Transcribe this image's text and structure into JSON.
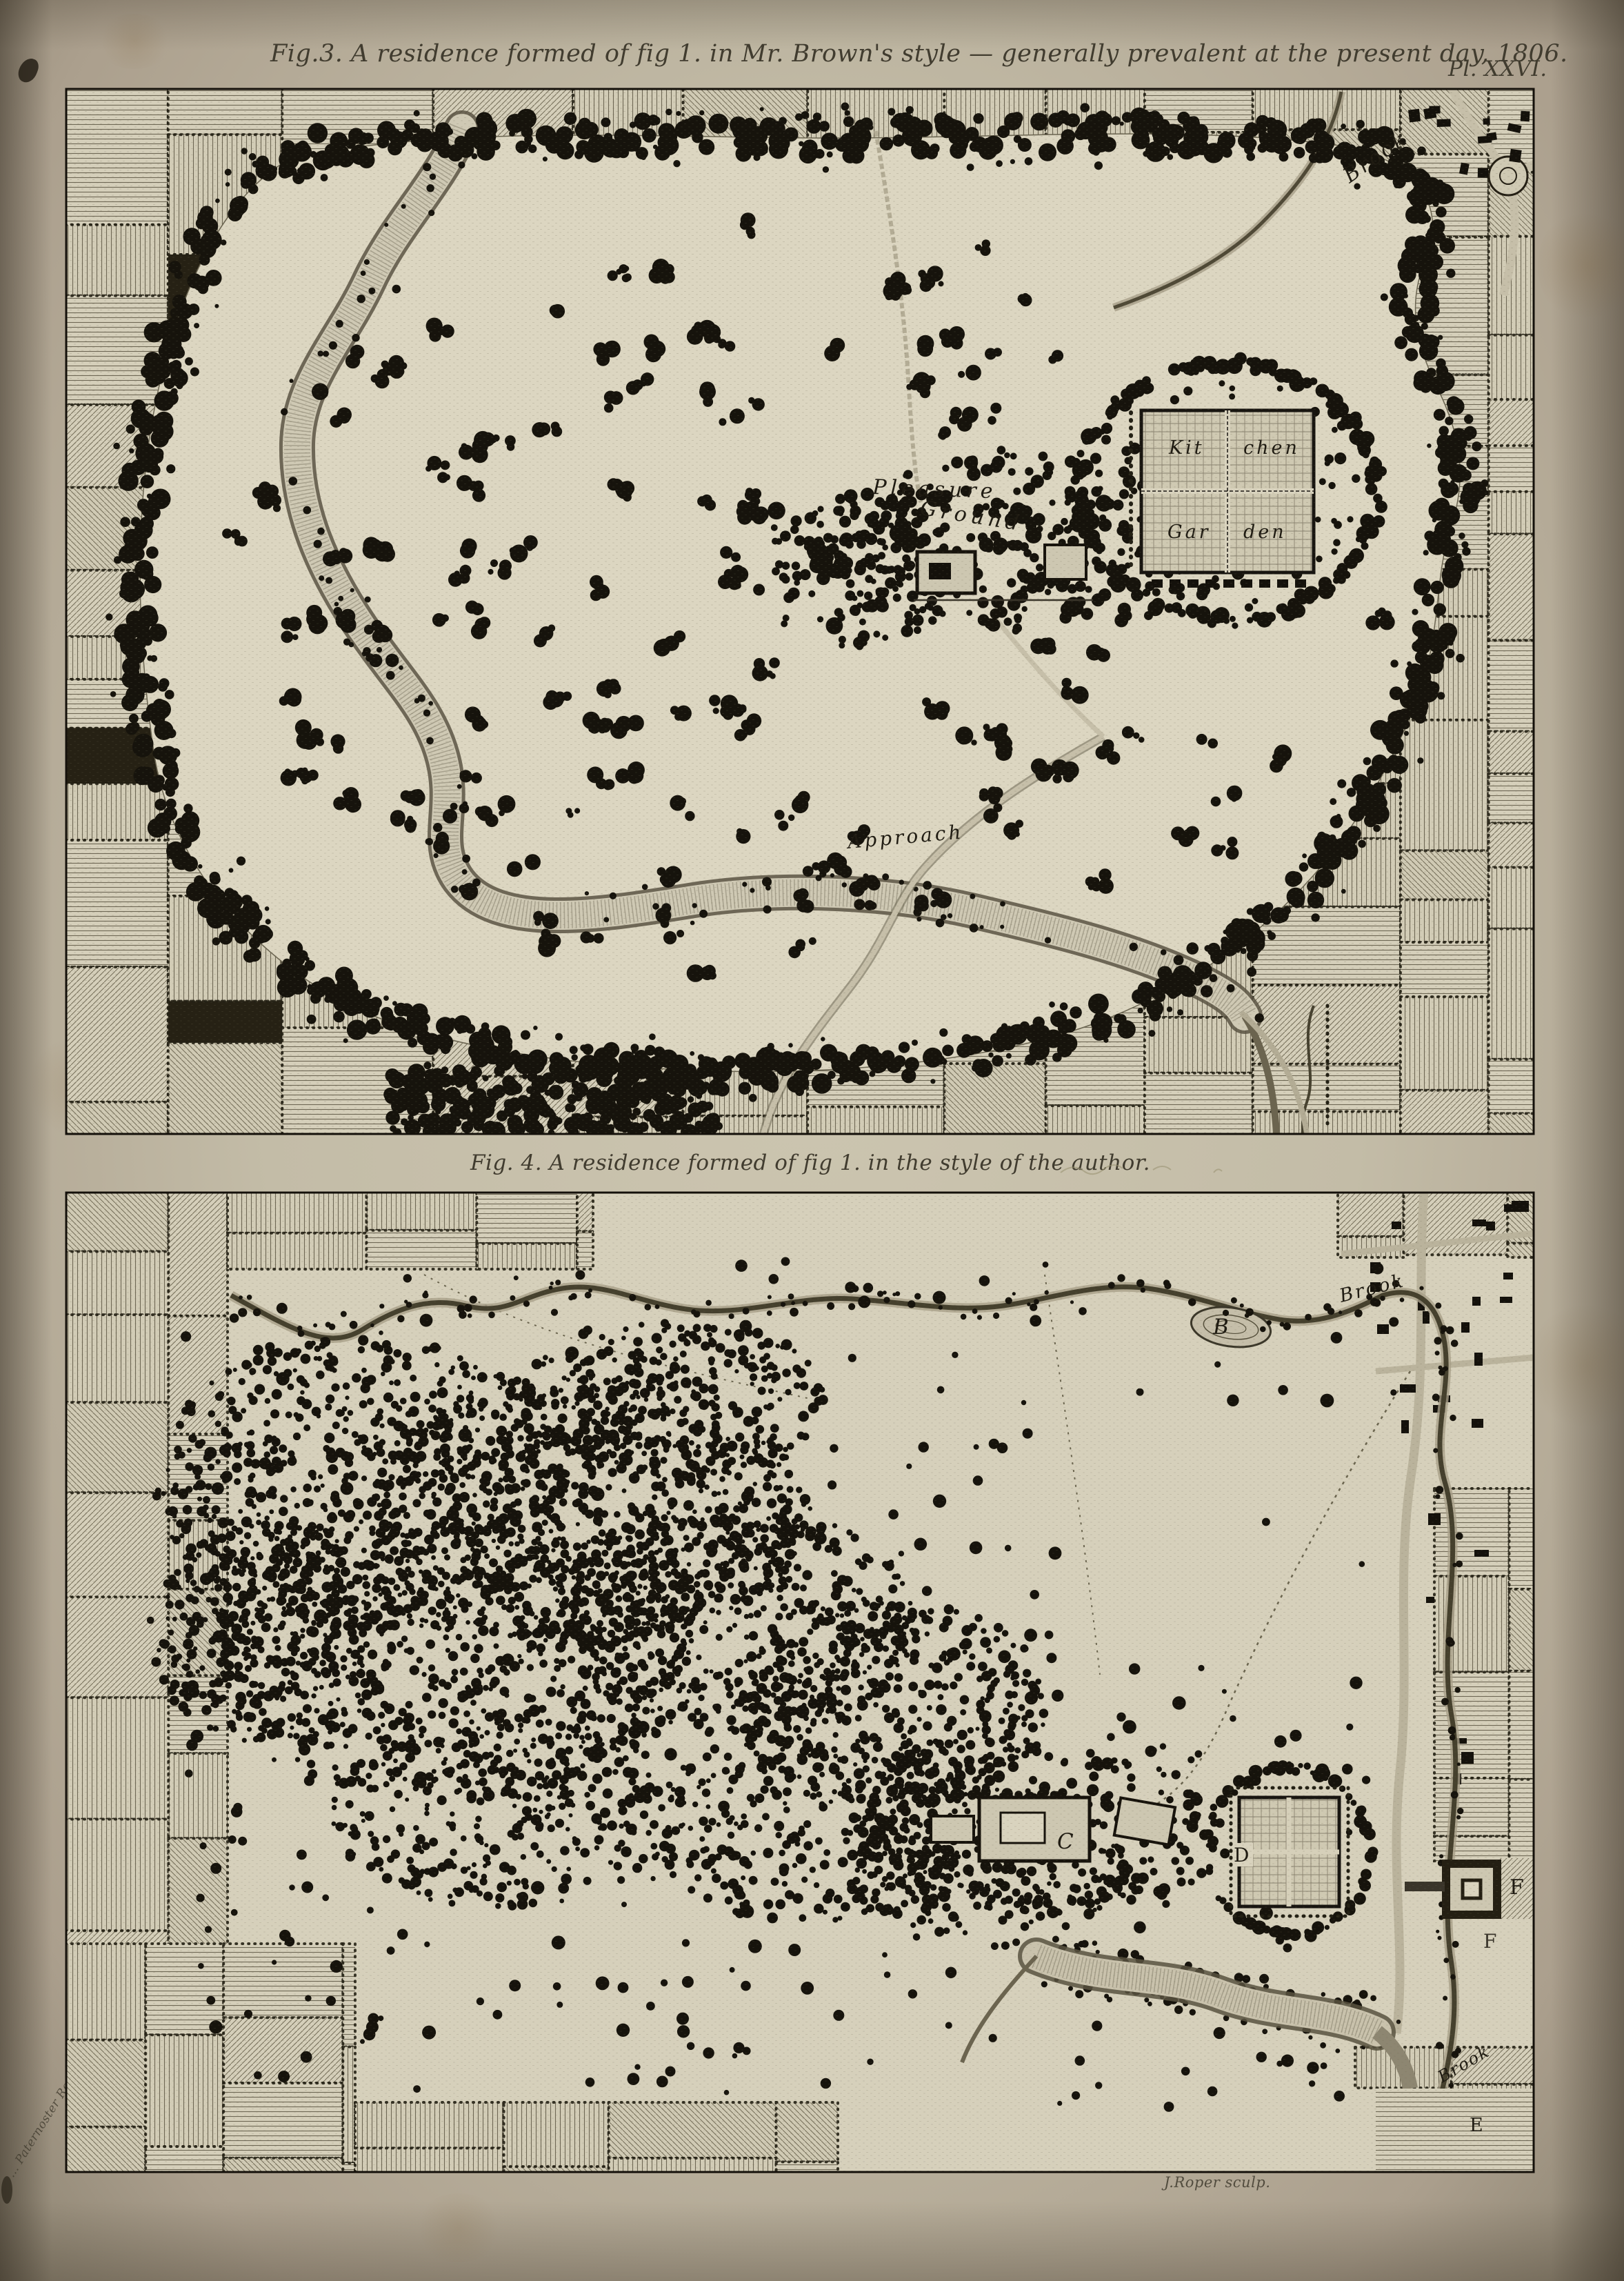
{
  "page": {
    "plate_label": "Pl. XXVI.",
    "engraver_credit": "J.Roper sculp.",
    "imprint": "… Paternoster Row."
  },
  "fig3": {
    "caption": "Fig.3. A residence formed of fig 1. in Mr. Brown's style — generally prevalent at the present day, 1806.",
    "labels": {
      "brook": "Brook",
      "pleasure": "Pleasure",
      "ground": "Ground",
      "kitchen_left": "Kit",
      "kitchen_right": "chen",
      "garden_left": "Gar",
      "garden_right": "den",
      "approach": "Approach"
    }
  },
  "fig4": {
    "caption": "Fig. 4. A residence formed of fig 1. in the style of the author.",
    "labels": {
      "brook_top": "Brook",
      "brook_bottom": "Brook",
      "b": "B",
      "c": "C",
      "d": "D",
      "e": "E",
      "f_upper": "F",
      "f_lower": "F"
    }
  }
}
